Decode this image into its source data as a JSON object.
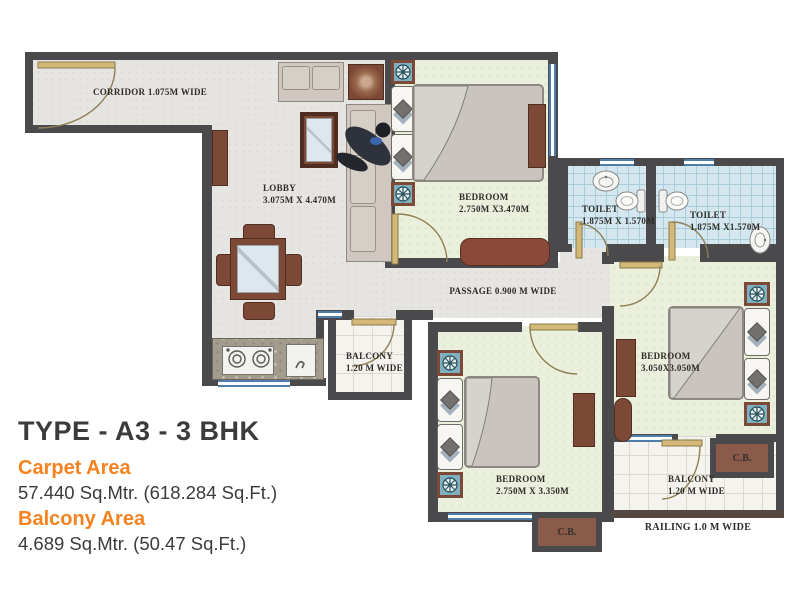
{
  "plan": {
    "corridor_label": "CORRIDOR 1.075M WIDE",
    "lobby": {
      "name": "LOBBY",
      "dims": "3.075M X 4.470M"
    },
    "bedroom1": {
      "name": "BEDROOM",
      "dims": "2.750M X3.470M"
    },
    "toilet1": {
      "name": "TOILET",
      "dims": "1.875M X 1.570M"
    },
    "toilet2": {
      "name": "TOILET",
      "dims": "1.875M X1.570M"
    },
    "passage_label": "PASSAGE 0.900 M WIDE",
    "balcony1": {
      "name": "BALCONY",
      "dims": "1.20 M WIDE"
    },
    "bedroom2": {
      "name": "BEDROOM",
      "dims": "2.750M X 3.350M"
    },
    "bedroom3": {
      "name": "BEDROOM",
      "dims": "3.050X3.050M"
    },
    "balcony2": {
      "name": "BALCONY",
      "dims": "1.20 M WIDE"
    },
    "cupboard1": "C.B.",
    "cupboard2": "C.B.",
    "railing_label": "RAILING 1.0 M WIDE"
  },
  "info": {
    "type_title": "TYPE - A3 - 3 BHK",
    "carpet_area_label": "Carpet Area",
    "carpet_area_value": "57.440 Sq.Mtr. (618.284 Sq.Ft.)",
    "balcony_area_label": "Balcony Area",
    "balcony_area_value": "4.689 Sq.Mtr. (50.47 Sq.Ft.)"
  },
  "colors": {
    "accent_orange": "#f5821f",
    "title_gray": "#3b3b3d",
    "wall": "#4a4a4d",
    "hall_floor": "#e6e5e1",
    "bedroom_floor": "#eaf0dc",
    "toilet_floor": "#d4e7ef",
    "balcony_floor": "#f4f3ee",
    "furniture_brown": "#7d4937"
  }
}
